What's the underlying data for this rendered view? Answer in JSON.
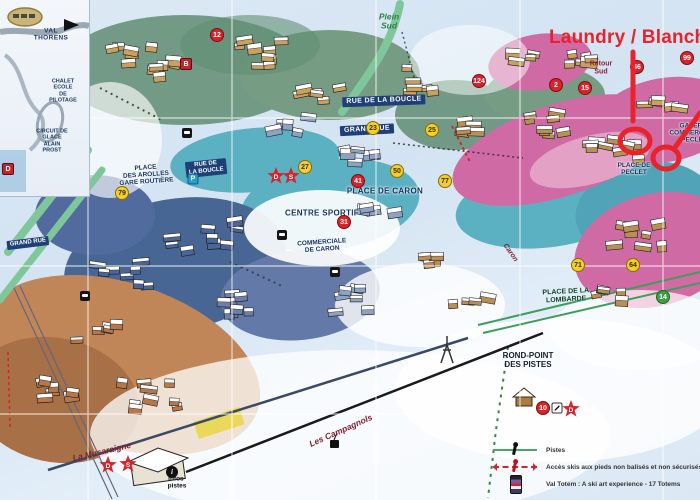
{
  "annotation": {
    "text": "Laundry / Blanch",
    "color": "#e8232a"
  },
  "inset": {
    "region_title": "VAL THORENS",
    "chalet_label": "CHALET ECOLE\nDE PILOTAGE",
    "circuit_label": "CIRCUIT DE GLACE\nALAIN PROST",
    "badge": "D"
  },
  "map": {
    "labels": [
      {
        "text": "Plein\nSud",
        "x": 389,
        "y": 22,
        "rot": 0,
        "style": "st-green-it"
      },
      {
        "text": "Retour\nSud",
        "x": 601,
        "y": 68,
        "rot": 0,
        "style": "st-retour"
      },
      {
        "text": "RUE DE LA BOUCLE",
        "x": 384,
        "y": 101,
        "rot": -2,
        "style": "st-street"
      },
      {
        "text": "RUE DE\nLA BOUCLE",
        "x": 206,
        "y": 168,
        "rot": -6,
        "style": "st-street-sm"
      },
      {
        "text": "PLACE\nDES AROLLES\nGARE ROUTIÈRE",
        "x": 146,
        "y": 175,
        "rot": -4,
        "style": "st-place"
      },
      {
        "text": "GRAND RUE",
        "x": 367,
        "y": 130,
        "rot": -3,
        "style": "st-street"
      },
      {
        "text": "GRAND RUE",
        "x": 28,
        "y": 243,
        "rot": -7,
        "style": "st-street-sm"
      },
      {
        "text": "CENTRE SPORTIF",
        "x": 322,
        "y": 214,
        "rot": 0,
        "style": "st-place-lg"
      },
      {
        "text": "COMMERCIALE\nDE CARON",
        "x": 322,
        "y": 246,
        "rot": -4,
        "style": "st-place"
      },
      {
        "text": "PLACE DE CARON",
        "x": 385,
        "y": 192,
        "rot": 0,
        "style": "st-place-lg"
      },
      {
        "text": "PLACE DE\nPECLET",
        "x": 634,
        "y": 169,
        "rot": 0,
        "style": "st-place"
      },
      {
        "text": "GALERIE\nCOMMERCIALE\nPECLET",
        "x": 694,
        "y": 133,
        "rot": 0,
        "style": "st-place"
      },
      {
        "text": "PLACE DE LA\nLOMBARDE",
        "x": 566,
        "y": 296,
        "rot": -3,
        "style": "st-place-green"
      },
      {
        "text": "ROND-POINT\nDES PISTES",
        "x": 528,
        "y": 361,
        "rot": 0,
        "style": "st-dark"
      },
      {
        "text": "La Musaraigne",
        "x": 102,
        "y": 452,
        "rot": -13,
        "style": "st-maroon"
      },
      {
        "text": "Les Campagnols",
        "x": 341,
        "y": 431,
        "rot": -24,
        "style": "st-maroon"
      },
      {
        "text": "infos-\npistes",
        "x": 177,
        "y": 483,
        "rot": 0,
        "style": "st-info"
      },
      {
        "text": "Caron",
        "x": 510,
        "y": 253,
        "rot": 55,
        "style": "st-maroon-sm"
      }
    ],
    "markers": [
      {
        "shape": "red",
        "label": "12",
        "x": 217,
        "y": 35
      },
      {
        "shape": "red-square",
        "label": "B",
        "x": 186,
        "y": 64
      },
      {
        "shape": "red",
        "label": "124",
        "x": 479,
        "y": 81
      },
      {
        "shape": "red",
        "label": "2",
        "x": 556,
        "y": 85
      },
      {
        "shape": "red",
        "label": "15",
        "x": 585,
        "y": 88
      },
      {
        "shape": "red",
        "label": "99",
        "x": 687,
        "y": 58
      },
      {
        "shape": "red",
        "label": "46",
        "x": 637,
        "y": 67
      },
      {
        "shape": "yellow",
        "label": "23",
        "x": 373,
        "y": 128
      },
      {
        "shape": "yellow",
        "label": "25",
        "x": 432,
        "y": 130
      },
      {
        "shape": "yellow",
        "label": "27",
        "x": 305,
        "y": 167
      },
      {
        "shape": "yellow",
        "label": "50",
        "x": 397,
        "y": 171
      },
      {
        "shape": "yellow",
        "label": "77",
        "x": 445,
        "y": 181
      },
      {
        "shape": "yellow",
        "label": "79",
        "x": 122,
        "y": 193
      },
      {
        "shape": "blue-square",
        "label": "P",
        "x": 193,
        "y": 179
      },
      {
        "shape": "red-star",
        "label": "D",
        "x": 276,
        "y": 176
      },
      {
        "shape": "red-star",
        "label": "S",
        "x": 291,
        "y": 176
      },
      {
        "shape": "red",
        "label": "41",
        "x": 358,
        "y": 181
      },
      {
        "shape": "red",
        "label": "31",
        "x": 344,
        "y": 222
      },
      {
        "shape": "yellow",
        "label": "71",
        "x": 578,
        "y": 265
      },
      {
        "shape": "yellow",
        "label": "64",
        "x": 633,
        "y": 265
      },
      {
        "shape": "green",
        "label": "14",
        "x": 663,
        "y": 297
      },
      {
        "shape": "red",
        "label": "10",
        "x": 543,
        "y": 408
      },
      {
        "shape": "white-square",
        "label": "",
        "x": 557,
        "y": 408
      },
      {
        "shape": "red-star",
        "label": "D",
        "x": 571,
        "y": 409
      },
      {
        "shape": "red-star",
        "label": "D",
        "x": 108,
        "y": 465
      },
      {
        "shape": "red-star",
        "label": "S",
        "x": 128,
        "y": 464
      },
      {
        "shape": "black",
        "label": "i",
        "x": 172,
        "y": 472
      },
      {
        "shape": "picto",
        "label": "",
        "x": 187,
        "y": 133
      },
      {
        "shape": "picto",
        "label": "",
        "x": 85,
        "y": 296
      },
      {
        "shape": "picto",
        "label": "",
        "x": 282,
        "y": 235
      },
      {
        "shape": "picto",
        "label": "",
        "x": 335,
        "y": 272
      }
    ]
  },
  "legend": {
    "items": [
      {
        "icon": "piste",
        "label": "Pistes"
      },
      {
        "icon": "access",
        "label": "Accès skis aux pieds non balisés et non sécurisés"
      },
      {
        "icon": "totem",
        "label": "Val Totem : A ski art experience - 17 Totems"
      }
    ]
  }
}
